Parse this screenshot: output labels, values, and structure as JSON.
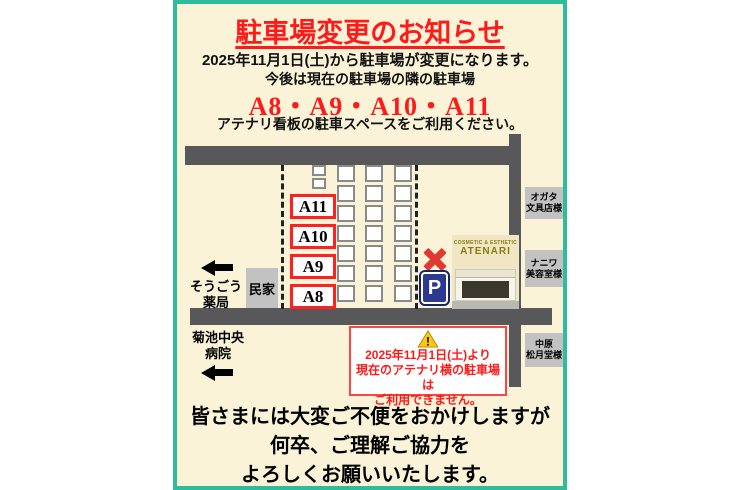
{
  "header": {
    "title": "駐車場変更のお知らせ",
    "line1": "2025年11月1日(土)から駐車場が変更になります。",
    "line2": "今後は現在の駐車場の隣の駐車場",
    "highlight": "A8・A9・A10・A11",
    "line3": "アテナリ看板の駐車スペースをご利用ください。"
  },
  "map": {
    "space_labels": [
      "A11",
      "A10",
      "A9",
      "A8"
    ],
    "house_label": "民家",
    "pharmacy": {
      "line1": "そうごう",
      "line2": "薬局"
    },
    "hospital": {
      "line1": "菊池中央",
      "line2": "病院"
    },
    "shops": [
      {
        "line1": "オガタ",
        "line2": "文具店様"
      },
      {
        "line1": "ナニワ",
        "line2": "美容室様"
      },
      {
        "line1": "中原",
        "line2": "松月堂様"
      }
    ],
    "building": {
      "sign_line1": "COSMETIC & ESTHETIC",
      "sign_line2": "ATENARI"
    },
    "p_sign": "P"
  },
  "warning": {
    "icon_mark": "!",
    "line1": "2025年11月1日(土)より",
    "line2": "現在のアテナリ横の駐車場は",
    "line3": "ご利用できません。"
  },
  "footer": {
    "line1": "皆さまには大変ご不便をおかけしますが",
    "line2": "何卒、ご理解ご協力を",
    "line3": "よろしくお願いいたします。"
  },
  "colors": {
    "accent_red": "#ff1a1a",
    "border_teal": "#2ebc9d",
    "road_gray": "#58585a",
    "flyer_cream": "#faf3d7",
    "p_sign_blue": "#2b3990",
    "warning_yellow": "#ffc60a"
  }
}
